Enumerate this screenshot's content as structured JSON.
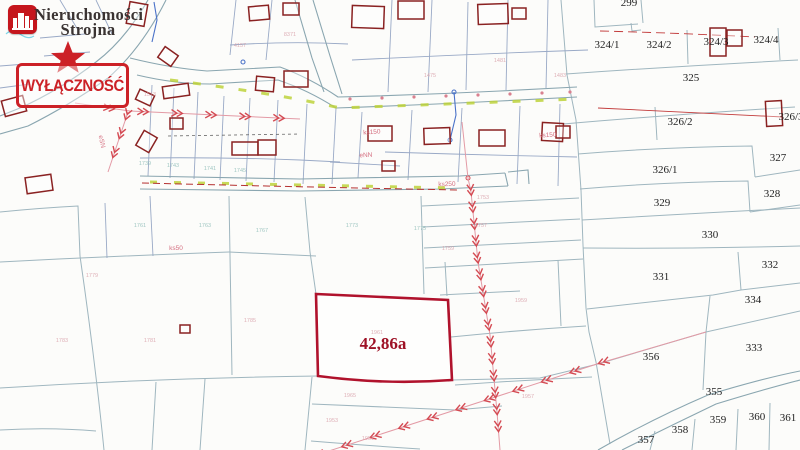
{
  "branding": {
    "company_line1": "Nieruchomości",
    "company_line2": "Strojna",
    "exclusivity_label": "WYŁĄCZNOŚĆ",
    "brand_red": "#c5161d",
    "stamp_red": "#cc2127"
  },
  "map": {
    "highlight": {
      "label": "42,86a",
      "color": "#b0122c"
    },
    "parcel_labels": [
      {
        "t": "299",
        "x": 629,
        "y": 6
      },
      {
        "t": "324/1",
        "x": 607,
        "y": 48
      },
      {
        "t": "324/2",
        "x": 659,
        "y": 48
      },
      {
        "t": "324/3",
        "x": 716,
        "y": 45
      },
      {
        "t": "324/4",
        "x": 766,
        "y": 43
      },
      {
        "t": "325",
        "x": 691,
        "y": 81
      },
      {
        "t": "326/2",
        "x": 680,
        "y": 125
      },
      {
        "t": "326/3",
        "x": 791,
        "y": 120
      },
      {
        "t": "327",
        "x": 778,
        "y": 161
      },
      {
        "t": "326/1",
        "x": 665,
        "y": 173
      },
      {
        "t": "328",
        "x": 772,
        "y": 197
      },
      {
        "t": "329",
        "x": 662,
        "y": 206
      },
      {
        "t": "330",
        "x": 710,
        "y": 238
      },
      {
        "t": "331",
        "x": 661,
        "y": 280
      },
      {
        "t": "332",
        "x": 770,
        "y": 268
      },
      {
        "t": "334",
        "x": 753,
        "y": 303
      },
      {
        "t": "333",
        "x": 754,
        "y": 351
      },
      {
        "t": "356",
        "x": 651,
        "y": 360
      },
      {
        "t": "355",
        "x": 714,
        "y": 395
      },
      {
        "t": "358",
        "x": 680,
        "y": 433
      },
      {
        "t": "359",
        "x": 718,
        "y": 423
      },
      {
        "t": "360",
        "x": 757,
        "y": 420
      },
      {
        "t": "361",
        "x": 788,
        "y": 421
      },
      {
        "t": "357",
        "x": 646,
        "y": 443
      }
    ],
    "faint_labels": [
      {
        "t": "4157",
        "x": 240,
        "y": 47,
        "c": "p"
      },
      {
        "t": "8371",
        "x": 290,
        "y": 36,
        "c": "p"
      },
      {
        "t": "1513",
        "x": 150,
        "y": 96,
        "c": "p"
      },
      {
        "t": "1475",
        "x": 430,
        "y": 77,
        "c": "p"
      },
      {
        "t": "1481",
        "x": 500,
        "y": 62,
        "c": "p"
      },
      {
        "t": "1483",
        "x": 560,
        "y": 77,
        "c": "p"
      },
      {
        "t": "1753",
        "x": 483,
        "y": 199,
        "c": "p"
      },
      {
        "t": "1757",
        "x": 481,
        "y": 227,
        "c": "p"
      },
      {
        "t": "1759",
        "x": 448,
        "y": 250,
        "c": "p"
      },
      {
        "t": "1961",
        "x": 377,
        "y": 334,
        "c": "p"
      },
      {
        "t": "1959",
        "x": 521,
        "y": 302,
        "c": "p"
      },
      {
        "t": "1957",
        "x": 528,
        "y": 398,
        "c": "p"
      },
      {
        "t": "1965",
        "x": 350,
        "y": 397,
        "c": "p"
      },
      {
        "t": "1953",
        "x": 332,
        "y": 422,
        "c": "p"
      },
      {
        "t": "1951",
        "x": 368,
        "y": 440,
        "c": "p"
      },
      {
        "t": "1779",
        "x": 92,
        "y": 277,
        "c": "p"
      },
      {
        "t": "1783",
        "x": 62,
        "y": 342,
        "c": "p"
      },
      {
        "t": "1781",
        "x": 150,
        "y": 342,
        "c": "p"
      },
      {
        "t": "1785",
        "x": 250,
        "y": 322,
        "c": "p"
      },
      {
        "t": "1761",
        "x": 140,
        "y": 227,
        "c": "t"
      },
      {
        "t": "1763",
        "x": 205,
        "y": 227,
        "c": "t"
      },
      {
        "t": "1767",
        "x": 262,
        "y": 232,
        "c": "t"
      },
      {
        "t": "1773",
        "x": 352,
        "y": 227,
        "c": "t"
      },
      {
        "t": "1775",
        "x": 420,
        "y": 230,
        "c": "t"
      },
      {
        "t": "1743",
        "x": 173,
        "y": 167,
        "c": "t"
      },
      {
        "t": "1741",
        "x": 210,
        "y": 170,
        "c": "t"
      },
      {
        "t": "1745",
        "x": 240,
        "y": 172,
        "c": "t"
      },
      {
        "t": "1739",
        "x": 145,
        "y": 165,
        "c": "t"
      }
    ],
    "utility_labels": [
      {
        "t": "ks150",
        "x": 372,
        "y": 134,
        "r": -4
      },
      {
        "t": "ks150",
        "x": 548,
        "y": 137,
        "r": -4
      },
      {
        "t": "ks250",
        "x": 447,
        "y": 186,
        "r": -2
      },
      {
        "t": "ks50",
        "x": 176,
        "y": 250,
        "r": 0
      },
      {
        "t": "eSN",
        "x": 100,
        "y": 142,
        "r": 78
      },
      {
        "t": "eNN",
        "x": 366,
        "y": 157,
        "r": -3
      }
    ],
    "buildings": [
      [
        3,
        98,
        22,
        16,
        -15
      ],
      [
        128,
        3,
        18,
        22,
        10
      ],
      [
        160,
        50,
        16,
        13,
        35
      ],
      [
        163,
        85,
        26,
        12,
        -8
      ],
      [
        137,
        92,
        16,
        11,
        25
      ],
      [
        170,
        118,
        13,
        11,
        0
      ],
      [
        139,
        133,
        15,
        17,
        30
      ],
      [
        232,
        142,
        26,
        13,
        0
      ],
      [
        258,
        140,
        18,
        15,
        0
      ],
      [
        26,
        176,
        26,
        16,
        -8
      ],
      [
        249,
        6,
        20,
        14,
        -5
      ],
      [
        283,
        3,
        16,
        12,
        0
      ],
      [
        352,
        6,
        32,
        22,
        2
      ],
      [
        398,
        1,
        26,
        18,
        0
      ],
      [
        478,
        4,
        30,
        20,
        -2
      ],
      [
        512,
        8,
        14,
        11,
        0
      ],
      [
        256,
        77,
        18,
        14,
        5
      ],
      [
        284,
        71,
        24,
        16,
        0
      ],
      [
        368,
        126,
        24,
        15,
        0
      ],
      [
        424,
        128,
        26,
        16,
        -2
      ],
      [
        479,
        130,
        26,
        16,
        0
      ],
      [
        542,
        123,
        21,
        18,
        3
      ],
      [
        382,
        161,
        13,
        10,
        0
      ],
      [
        710,
        28,
        16,
        28,
        0
      ],
      [
        727,
        30,
        15,
        16,
        0
      ],
      [
        766,
        101,
        16,
        25,
        -3
      ],
      [
        556,
        126,
        14,
        12,
        0
      ],
      [
        180,
        325,
        10,
        8,
        0
      ]
    ],
    "power_lines": [
      {
        "pts": [
          [
            706,
            332
          ],
          [
            600,
            363
          ],
          [
            295,
            462
          ]
        ],
        "arrow_from": 112,
        "gap": 30
      },
      {
        "pts": [
          [
            462,
            122
          ],
          [
            468,
            178
          ],
          [
            471,
            192
          ],
          [
            478,
            262
          ],
          [
            490,
            335
          ],
          [
            497,
            412
          ],
          [
            500,
            450
          ]
        ],
        "arrow_from": 74,
        "gap": 17
      },
      {
        "pts": [
          [
            75,
            103
          ],
          [
            130,
            111
          ],
          [
            300,
            119
          ]
        ],
        "arrow_from": 40,
        "gap": 34
      },
      {
        "pts": [
          [
            128,
            112
          ],
          [
            108,
            172
          ]
        ],
        "arrow_from": 8,
        "gap": 20
      }
    ],
    "colors": {
      "highlight": "#b0122c",
      "building": "#8a2222",
      "power": "#d44a52",
      "parcel_line": "#9fb6bf",
      "green_utility": "#bdd23b",
      "blue_utility": "#4a72c8",
      "red_utility": "#c23b3b"
    }
  }
}
